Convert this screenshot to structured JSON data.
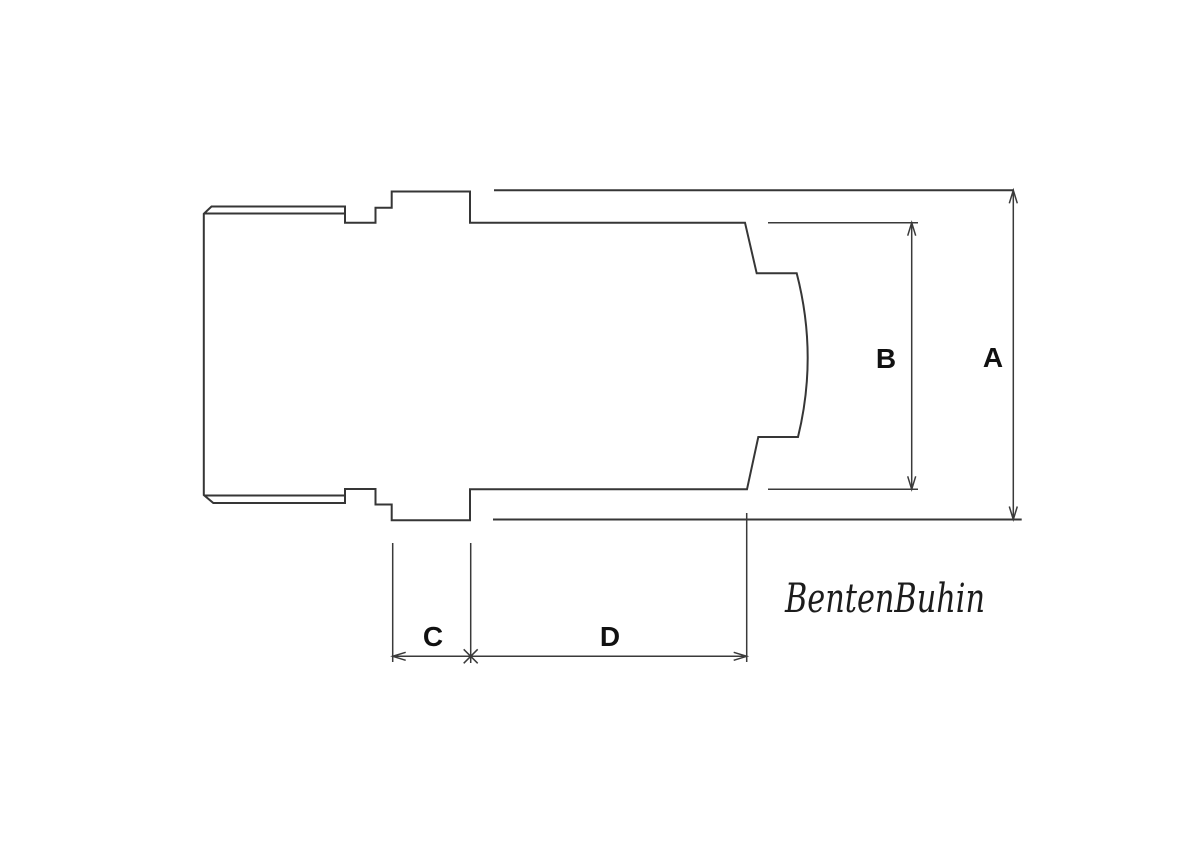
{
  "window": {
    "background_color": "#ffffff"
  },
  "drawing": {
    "type": "technical-dimension-drawing",
    "subject": "threaded coupler side profile with internal recess",
    "colors": {
      "object_line": "#363636",
      "dimension_line": "#3a3a3a",
      "label_text": "#111111",
      "signature_text": "#1c1c1c"
    },
    "dimensions": {
      "a_label": "A",
      "b_label": "B",
      "c_label": "C",
      "d_label": "D"
    },
    "signature": "BentenBuhin"
  }
}
